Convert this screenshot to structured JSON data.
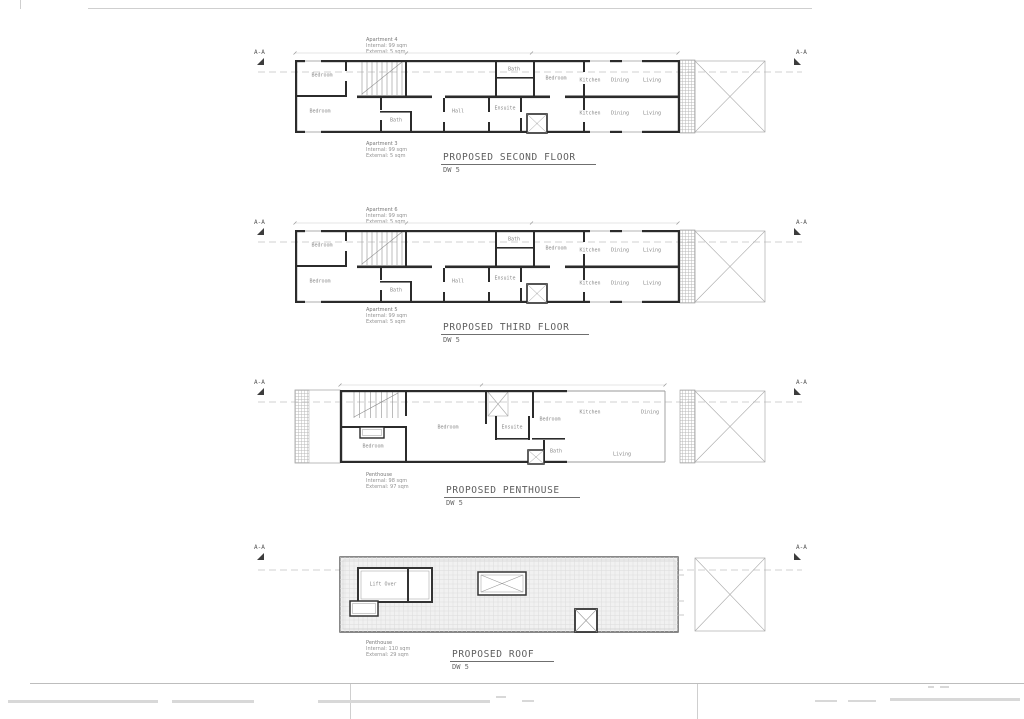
{
  "sheet": {
    "section_marker": "A-A",
    "drawing_ref": "DW 5"
  },
  "floors": {
    "second": {
      "title": "PROPOSED SECOND FLOOR",
      "drawing_no": "DW 5",
      "note_top": [
        "Apartment 4",
        "Internal: 99 sqm",
        "External: 5 sqm"
      ],
      "note_bottom": [
        "Apartment 3",
        "Internal: 99 sqm",
        "External: 5 sqm"
      ],
      "rooms": {
        "bedroom_a": "Bedroom",
        "bedroom_b": "Bedroom",
        "bedroom_c": "Bedroom",
        "bath_a": "Bath",
        "bath_b": "Bath",
        "ensuite": "Ensuite",
        "hall": "Hall",
        "kitchen_a": "Kitchen",
        "dining_a": "Dining",
        "living_a": "Living",
        "kitchen_b": "Kitchen",
        "dining_b": "Dining",
        "living_b": "Living"
      }
    },
    "third": {
      "title": "PROPOSED THIRD FLOOR",
      "drawing_no": "DW 5",
      "note_top": [
        "Apartment 6",
        "Internal: 99 sqm",
        "External: 5 sqm"
      ],
      "note_bottom": [
        "Apartment 5",
        "Internal: 99 sqm",
        "External: 5 sqm"
      ],
      "rooms": {
        "bedroom_a": "Bedroom",
        "bedroom_b": "Bedroom",
        "bedroom_c": "Bedroom",
        "bath_a": "Bath",
        "bath_b": "Bath",
        "ensuite": "Ensuite",
        "hall": "Hall",
        "kitchen_a": "Kitchen",
        "dining_a": "Dining",
        "living_a": "Living",
        "kitchen_b": "Kitchen",
        "dining_b": "Dining",
        "living_b": "Living"
      }
    },
    "penthouse": {
      "title": "PROPOSED PENTHOUSE",
      "drawing_no": "DW 5",
      "note": [
        "Penthouse",
        "Internal: 98 sqm",
        "External: 97 sqm"
      ],
      "rooms": {
        "bedroom_a": "Bedroom",
        "bedroom_b": "Bedroom",
        "bedroom_c": "Bedroom",
        "ensuite": "Ensuite",
        "bath": "Bath",
        "kitchen": "Kitchen",
        "dining": "Dining",
        "living": "Living"
      }
    },
    "roof": {
      "title": "PROPOSED ROOF",
      "drawing_no": "DW 5",
      "note": [
        "Penthouse",
        "Internal: 110 sqm",
        "External: 29 sqm"
      ],
      "rooms": {
        "lift": "Lift Over"
      }
    }
  },
  "colors": {
    "wall": "#2b2b2b",
    "thin_line": "#9a9a9a",
    "hatch": "#b8b8b8",
    "centerline": "#c4c4c4",
    "label_text": "#8a8a8a",
    "title_text": "#5e5e5e",
    "roof_fill": "#f1f1f1"
  }
}
